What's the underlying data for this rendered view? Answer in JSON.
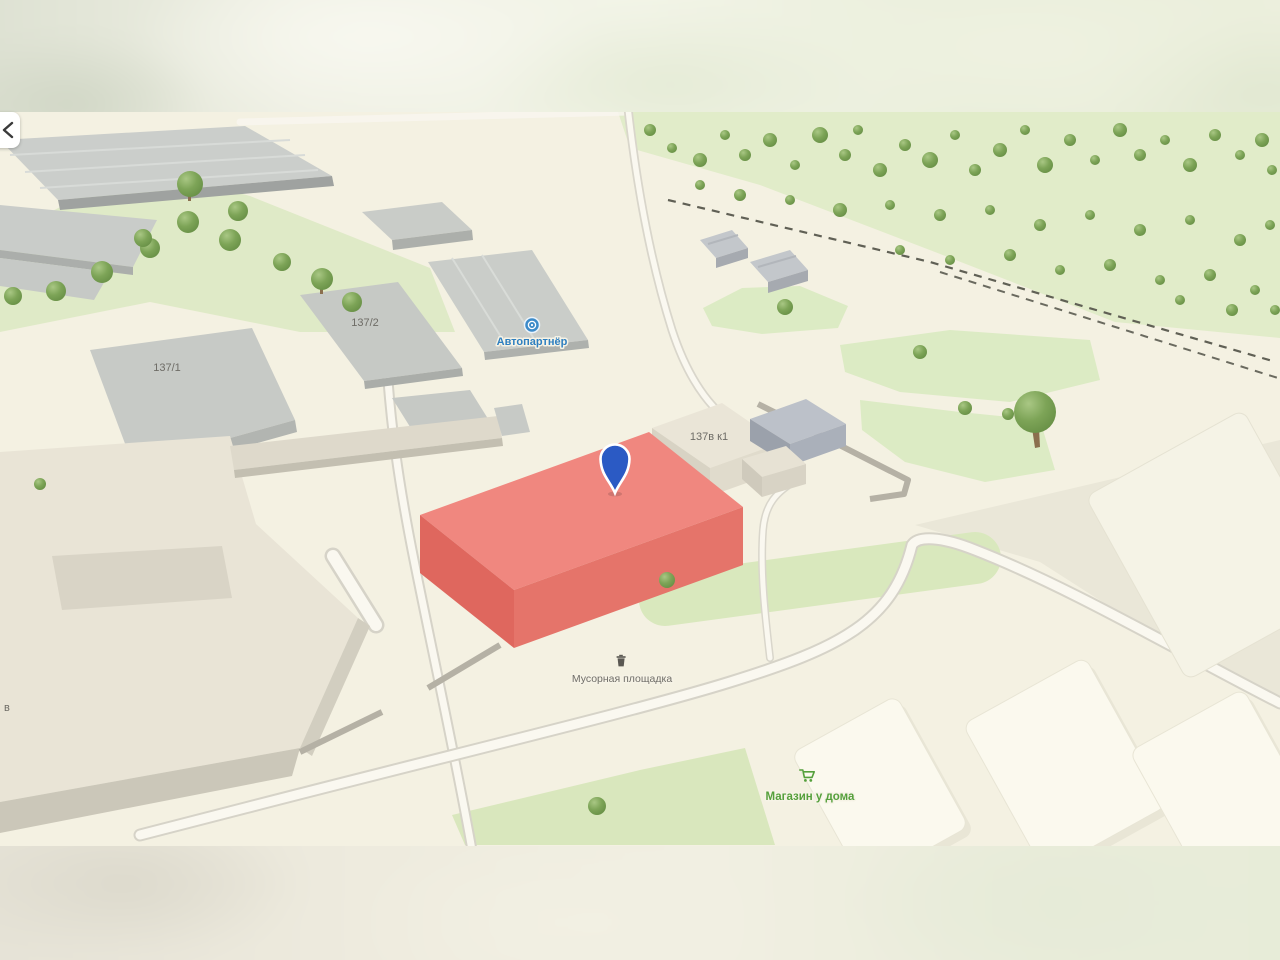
{
  "map": {
    "back_button": {
      "icon": "chevron-left"
    },
    "pin": {
      "color": "#2b5ac4",
      "outline": "#ffffff"
    },
    "highlight_building": {
      "top": "#f0877f",
      "left_side": "#df675e",
      "right_side": "#e5746a"
    },
    "buildings": [
      {
        "id": "137-1",
        "label": "137/1"
      },
      {
        "id": "137-2",
        "label": "137/2"
      },
      {
        "id": "137v-k1",
        "label": "137в к1"
      }
    ],
    "pois": [
      {
        "id": "autopartner",
        "label": "Автопартнёр",
        "color": "#2e7fc0",
        "icon": "steering-wheel-icon"
      },
      {
        "id": "trash-area",
        "label": "Мусорная площадка",
        "color": "#6f6d68",
        "icon": "trash-icon"
      },
      {
        "id": "shop",
        "label": "Магазин у дома",
        "color": "#55a03c",
        "icon": "cart-icon"
      }
    ],
    "partial_label": "в",
    "palette": {
      "ground": "#f4f1e2",
      "lawn": "#dcebc4",
      "forest": "#e1ecc9",
      "road_fill": "#faf8f0",
      "road_casing": "#d6d3c8",
      "building_gray": "#c9ccc8",
      "building_beige": "#e9e4d6",
      "fence": "#b5b1a5",
      "railway": "#60605"
    }
  }
}
